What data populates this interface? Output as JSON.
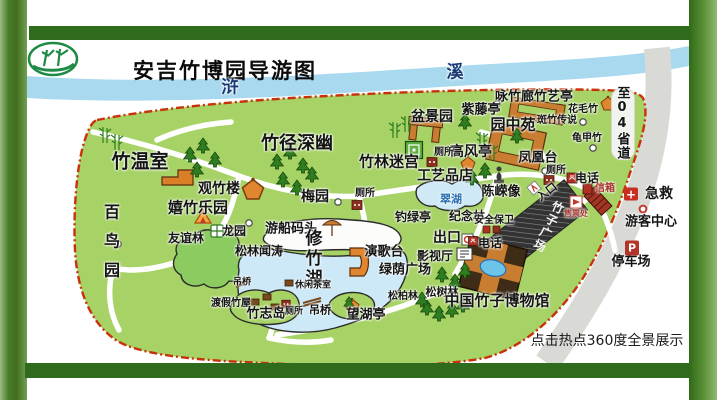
{
  "title": "安吉竹博园导游图",
  "river": {
    "char1": "浒",
    "char2": "溪"
  },
  "road_label": "至04省道",
  "footer_hint": "点击热点360度全景展示",
  "icons": {
    "parking": "P",
    "first_aid": "+"
  },
  "colors": {
    "frame_green": "#2e6b1d",
    "park_green": "#a7d266",
    "river_blue": "#a9d9ee",
    "boundary_red": "#c9310b",
    "road_gray": "#d9d9d6",
    "plaza_dark": "#333333"
  },
  "places": {
    "zhu_wenshi": "竹温室",
    "zhujing_shenyou": "竹径深幽",
    "guanzhulou": "观竹楼",
    "meiyuan": "梅园",
    "xizhu_leyuan": "嬉竹乐园",
    "bainiaoyuan": "百鸟园",
    "youyilin": "友谊林",
    "longyuan": "龙园",
    "songlin_wentao": "松林闻涛",
    "youchuan_matou": "游船码头",
    "xiuzhuhu": "修竹湖",
    "diaoqiao_w": "吊桥",
    "dujia_zhuwu": "渡假竹屋",
    "zhuzhidao": "竹志岛",
    "cesuo_island": "厕所",
    "xiuxian_chashi": "休闲茶室",
    "diaoqiao_e": "吊桥",
    "wanghuting": "望湖亭",
    "diaolvting": "钓绿亭",
    "jinianlin": "纪念林",
    "cuihu": "翠湖",
    "cesuo_meiyuan": "厕所",
    "zhulin_migong": "竹林迷宫",
    "gongyipindian": "工艺品店",
    "penjingyuan": "盆景园",
    "zitengting": "紫藤亭",
    "yongzhulang_zhuyiting": "咏竹廊竹艺亭",
    "yuanzhongyuan": "园中苑",
    "banzhu_chuanshuo": "斑竹传说",
    "huamaozhu": "花毛竹",
    "guijiazhu": "龟甲竹",
    "gaofengting": "高风亭",
    "fenghuangtai": "凤凰台",
    "cesuo_gaofengting": "厕所",
    "chenrongxiang": "陈嵘像",
    "rukou": "入口",
    "cesuo_rukou": "厕所",
    "dianhua_rukou": "电话",
    "xinxiang": "信箱",
    "shoupiaochu": "售票处",
    "anquan_baowei": "安全保卫",
    "chukou": "出口",
    "dianhua_chukou": "电话",
    "yangetai": "演歌台",
    "yingshiting": "影视厅",
    "lvyin_guangchang": "绿荫广场",
    "songbolin": "松柏林",
    "songshulin": "松树林",
    "bowuguan": "中国竹子博物馆",
    "zhuzi_guangchang": "竹子广场",
    "jijiu": "急救",
    "youke_zhongxin": "游客中心",
    "tingchechang": "停车场"
  }
}
